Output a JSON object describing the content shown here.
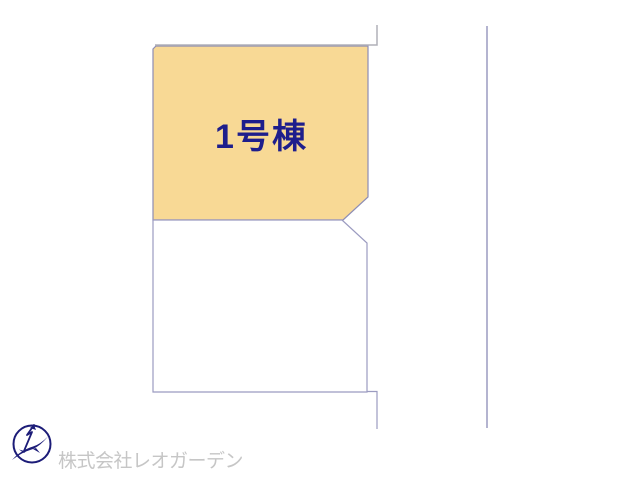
{
  "page": {
    "background_color": "#ffffff",
    "type": "real-estate-plot-map"
  },
  "plot_map": {
    "lot1": {
      "label": "1号棟",
      "fill_color": "#f8d995",
      "label_color": "#1e1e8c"
    },
    "lot2": {
      "label": "",
      "fill_color": "#ffffff"
    },
    "lot_outline_color": "#8d8db5",
    "boundary_line_color": "#b0b0b8"
  },
  "footer": {
    "company_name": "株式会社レオガーデン",
    "company_name_color": "#c6c6c6",
    "logo_icon": "bird-compass-circle-logo",
    "logo_color": "#1c1c78"
  }
}
